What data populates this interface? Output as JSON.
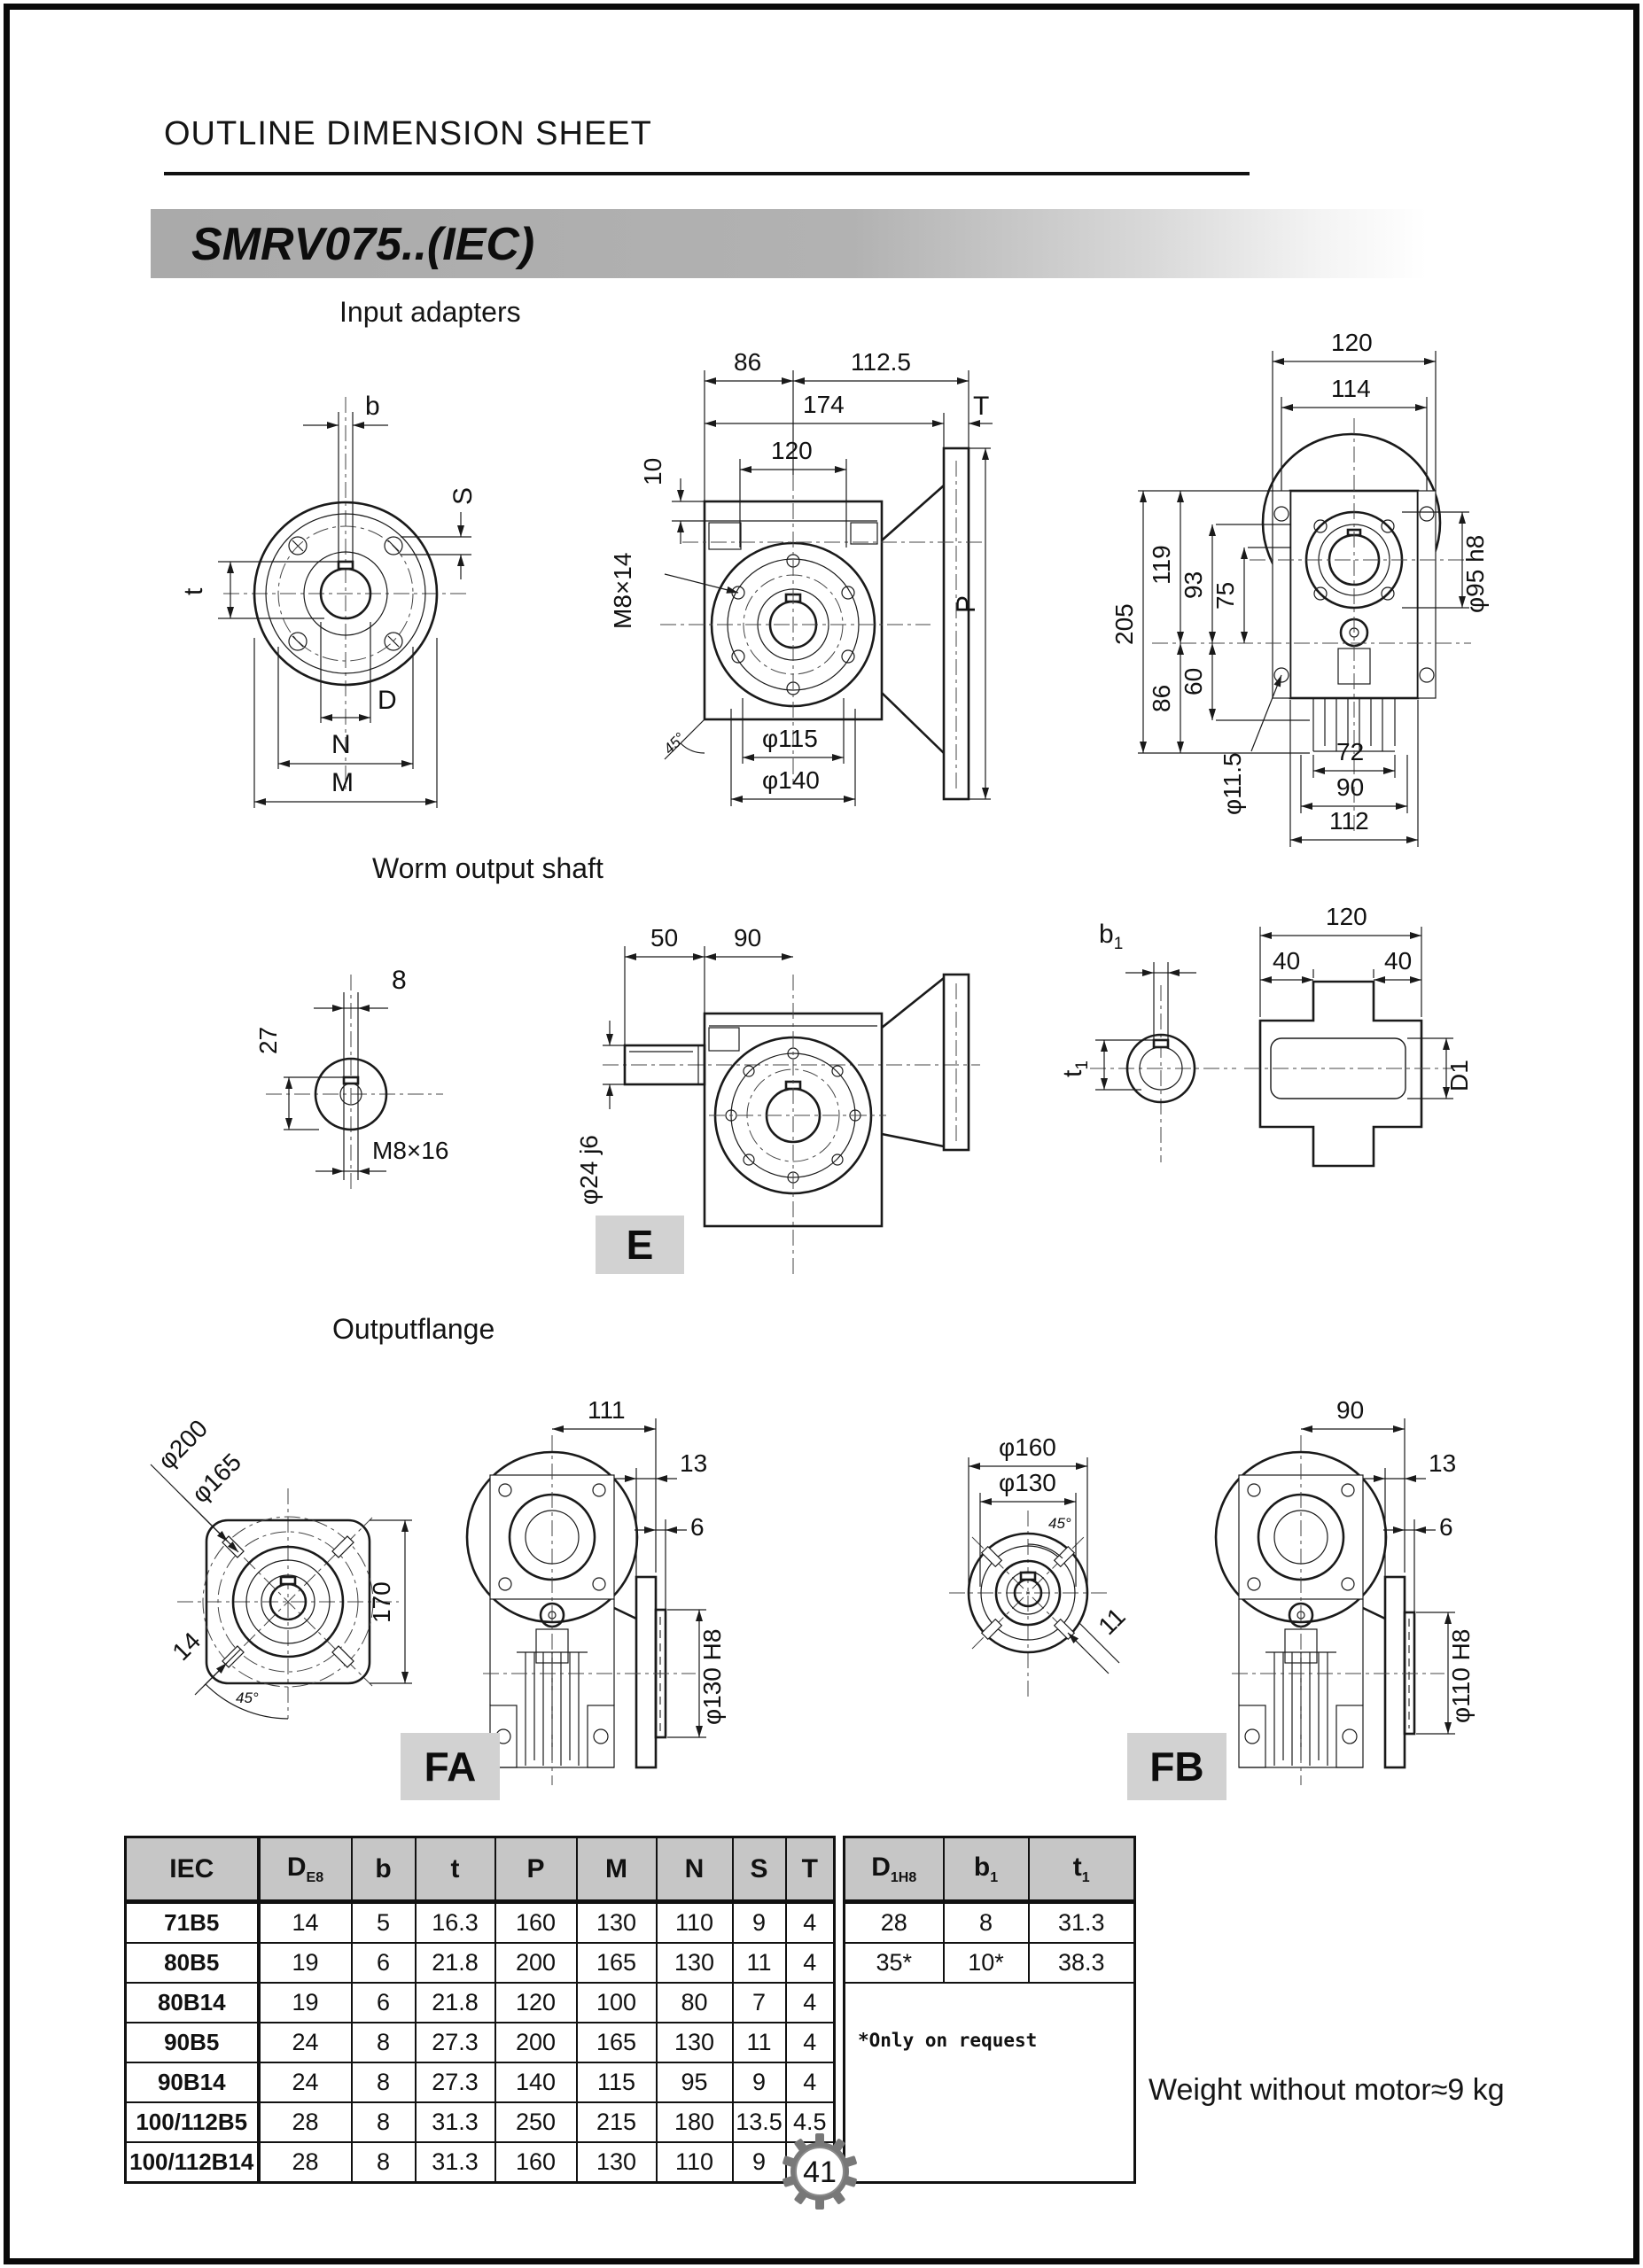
{
  "page": {
    "title": "OUTLINE DIMENSION SHEET",
    "model": "SMRV075..(IEC)",
    "page_number": "41",
    "weight_note": "Weight without motor≈9 kg"
  },
  "sections": {
    "input_adapters": "Input adapters",
    "worm_output_shaft": "Worm output shaft",
    "output_flange": "Outputflange"
  },
  "view_labels": {
    "e": "E",
    "fa": "FA",
    "fb": "FB"
  },
  "dims": {
    "ia_front": {
      "b": "b",
      "s": "S",
      "t": "t",
      "d": "D",
      "n": "N",
      "m": "M"
    },
    "ia_side": {
      "w86": "86",
      "w112_5": "112.5",
      "w174": "174",
      "w120": "120",
      "t": "T",
      "h10": "10",
      "m8x14": "M8×14",
      "p": "P",
      "d115": "φ115",
      "d140": "φ140",
      "a45": "45°"
    },
    "ia_back": {
      "w120": "120",
      "w114": "114",
      "h205": "205",
      "h119": "119",
      "h93": "93",
      "h75": "75",
      "h86": "86",
      "h60": "60",
      "d95": "φ95 h8",
      "d11_5": "φ11.5",
      "w72": "72",
      "w90": "90",
      "w112": "112"
    },
    "ws_end": {
      "w8": "8",
      "h27": "27",
      "m8x16": "M8×16"
    },
    "ws_side": {
      "w50": "50",
      "w90": "90",
      "d24": "φ24 j6"
    },
    "ws_hollow": {
      "b1": "b",
      "b1s": "1",
      "t1": "t",
      "t1s": "1",
      "w120": "120",
      "w40a": "40",
      "w40b": "40",
      "d1": "D1"
    },
    "fa_front": {
      "d200": "φ200",
      "d165": "φ165",
      "h170": "170",
      "s14": "14",
      "a45": "45°"
    },
    "fa_side": {
      "w111": "111",
      "w13": "13",
      "w6": "6",
      "d130": "φ130 H8"
    },
    "fb_front": {
      "d160": "φ160",
      "d130": "φ130",
      "a45": "45°",
      "s11": "11"
    },
    "fb_side": {
      "w90": "90",
      "w13": "13",
      "w6": "6",
      "d110": "φ110 H8"
    }
  },
  "table": {
    "headers": {
      "iec": "IEC",
      "d": "D",
      "d_sub": "E8",
      "b": "b",
      "t": "t",
      "p": "P",
      "m": "M",
      "n": "N",
      "s": "S",
      "T": "T",
      "d1": "D",
      "d1_sub": "1H8",
      "b1": "b",
      "b1_sub": "1",
      "t1": "t",
      "t1_sub": "1"
    },
    "rows": [
      {
        "iec": "71B5",
        "d": "14",
        "b": "5",
        "t": "16.3",
        "p": "160",
        "m": "130",
        "n": "110",
        "s": "9",
        "T": "4"
      },
      {
        "iec": "80B5",
        "d": "19",
        "b": "6",
        "t": "21.8",
        "p": "200",
        "m": "165",
        "n": "130",
        "s": "11",
        "T": "4"
      },
      {
        "iec": "80B14",
        "d": "19",
        "b": "6",
        "t": "21.8",
        "p": "120",
        "m": "100",
        "n": "80",
        "s": "7",
        "T": "4"
      },
      {
        "iec": "90B5",
        "d": "24",
        "b": "8",
        "t": "27.3",
        "p": "200",
        "m": "165",
        "n": "130",
        "s": "11",
        "T": "4"
      },
      {
        "iec": "90B14",
        "d": "24",
        "b": "8",
        "t": "27.3",
        "p": "140",
        "m": "115",
        "n": "95",
        "s": "9",
        "T": "4"
      },
      {
        "iec": "100/112B5",
        "d": "28",
        "b": "8",
        "t": "31.3",
        "p": "250",
        "m": "215",
        "n": "180",
        "s": "13.5",
        "T": "4.5"
      },
      {
        "iec": "100/112B14",
        "d": "28",
        "b": "8",
        "t": "31.3",
        "p": "160",
        "m": "130",
        "n": "110",
        "s": "9",
        "T": "4.5"
      }
    ],
    "right_rows": [
      {
        "d1": "28",
        "b1": "8",
        "t1": "31.3"
      },
      {
        "d1": "35*",
        "b1": "10*",
        "t1": "38.3"
      }
    ],
    "note": "*Only on request"
  }
}
